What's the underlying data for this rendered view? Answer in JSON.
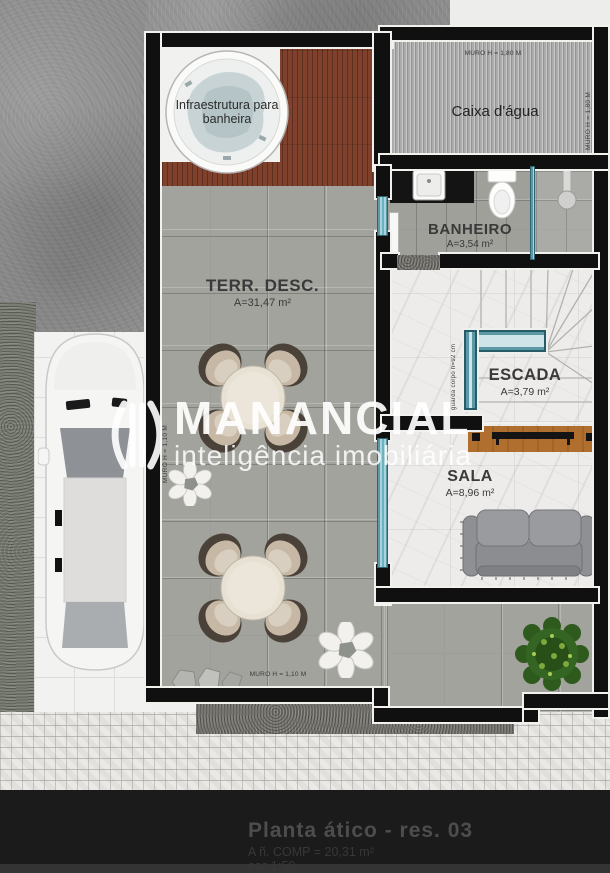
{
  "caption": {
    "title": "Planta ático - res. 03",
    "area_line": "A ñ. COMP = 20,31 m²",
    "scale_line": "esc 1:50"
  },
  "watermark": {
    "brand": "MANANCIAL",
    "tagline": "inteligência imobiliária"
  },
  "rooms": {
    "terrace": {
      "name": "TERR. DESC.",
      "area": "A=31,47 m²"
    },
    "bathroom": {
      "name": "BANHEIRO",
      "area": "A=3,54 m²"
    },
    "stairs": {
      "name": "ESCADA",
      "area": "A=3,79 m²"
    },
    "living": {
      "name": "SALA",
      "area": "A=8,96 m²"
    },
    "water_tank": {
      "name": "Caixa d'água"
    },
    "deck": {
      "note": "Infraestrutura para banheira"
    }
  },
  "annotations": {
    "wall_top": "MURO H = 1,80 M",
    "wall_right": "MURO H = 1,80 M",
    "wall_left": "MURO H = 1,10 M",
    "wall_bottom": "MURO H = 1,10 M",
    "stair_rail": "guarda corpo h=92 cm"
  },
  "colors": {
    "wall": "#101010",
    "glass_accent": "#7cc0cc",
    "deck_wood": "#7f412c",
    "caption_title": "#4d4d4d"
  }
}
